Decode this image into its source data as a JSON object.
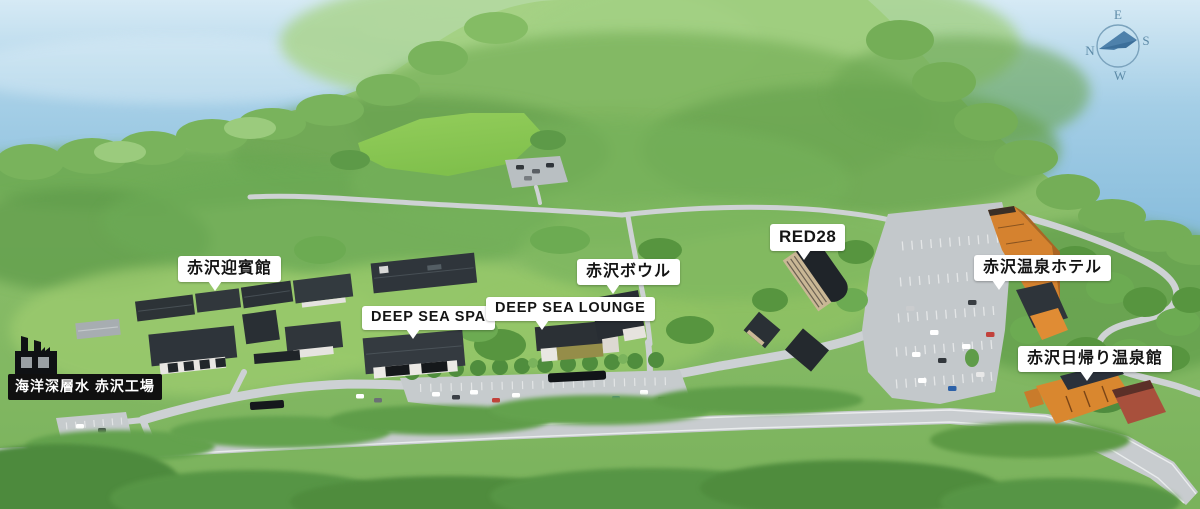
{
  "map": {
    "region_labels": {
      "geihinkan": "赤沢迎賓館",
      "deep_sea_spa": "DEEP SEA SPA",
      "deep_sea_lounge": "DEEP SEA LOUNGE",
      "bowl": "赤沢ボウル",
      "red28": "RED28",
      "onsen_hotel": "赤沢温泉ホテル",
      "higaeri_onsenkan": "赤沢日帰り温泉館",
      "factory": "海洋深層水 赤沢工場"
    },
    "compass": {
      "north": "N",
      "east": "E",
      "south": "S",
      "west": "W"
    },
    "colors": {
      "sea": "#8fc2de",
      "land": "#86bd66",
      "field": "#8cc953",
      "road": "#ced2d4",
      "dark_roof": "#2e343a",
      "orange_building": "#d9872f",
      "red_building": "#a8503c",
      "label_bg": "#ffffff",
      "label_text": "#141414",
      "factory_label_bg": "#101010",
      "factory_label_text": "#ffffff",
      "compass": "#4e81ab"
    }
  }
}
